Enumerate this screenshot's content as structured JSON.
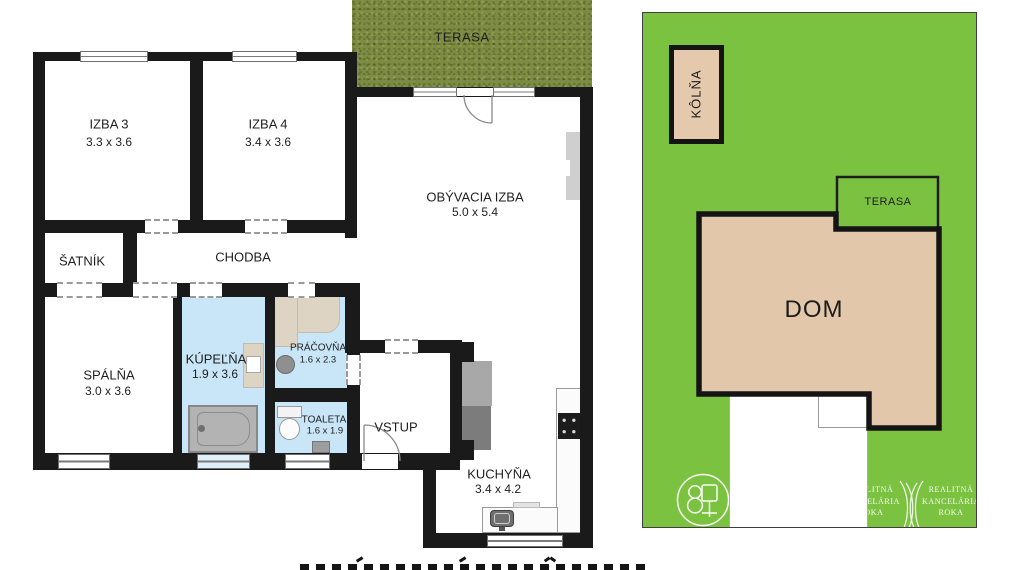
{
  "floor_plan": {
    "terrace": {
      "label": "TERASA"
    },
    "rooms": {
      "izba3": {
        "name": "IZBA 3",
        "dims": "3.3 x 3.6"
      },
      "izba4": {
        "name": "IZBA 4",
        "dims": "3.4 x 3.6"
      },
      "obyvacia_izba": {
        "name": "OBÝVACIA IZBA",
        "dims": "5.0 x 5.4"
      },
      "satnik": {
        "name": "ŠATNÍK"
      },
      "chodba": {
        "name": "CHODBA"
      },
      "spalna": {
        "name": "SPÁLŇA",
        "dims": "3.0 x 3.6"
      },
      "kupelna": {
        "name": "KÚPEĽŇA",
        "dims": "1.9 x 3.6"
      },
      "pracovna": {
        "name": "PRÁČOVŇA",
        "dims": "1.6 x 2.3"
      },
      "toaleta": {
        "name": "TOALETA",
        "dims": "1.6 x 1.9"
      },
      "vstup": {
        "name": "VSTUP"
      },
      "kuchyna": {
        "name": "KUCHYŇA",
        "dims": "3.4 x 4.2"
      }
    }
  },
  "site_plan": {
    "shed": {
      "label": "KÔLŇA"
    },
    "terrace": {
      "label": "TERASA"
    },
    "house": {
      "label": "DOM"
    },
    "watermark": {
      "line1": "REALITNÁ",
      "line2": "KANCELÁRIA",
      "line3": "ROKA"
    }
  },
  "colors": {
    "wall": "#1a1a1a",
    "bathroom_blue": "#c8e6f7",
    "terrace_grass": "#7d8c42",
    "lot_green": "#7cc241",
    "house_tan": "#e2c7ab",
    "shed_tan": "#e5c9ad",
    "watermark_white": "#ffffff"
  }
}
